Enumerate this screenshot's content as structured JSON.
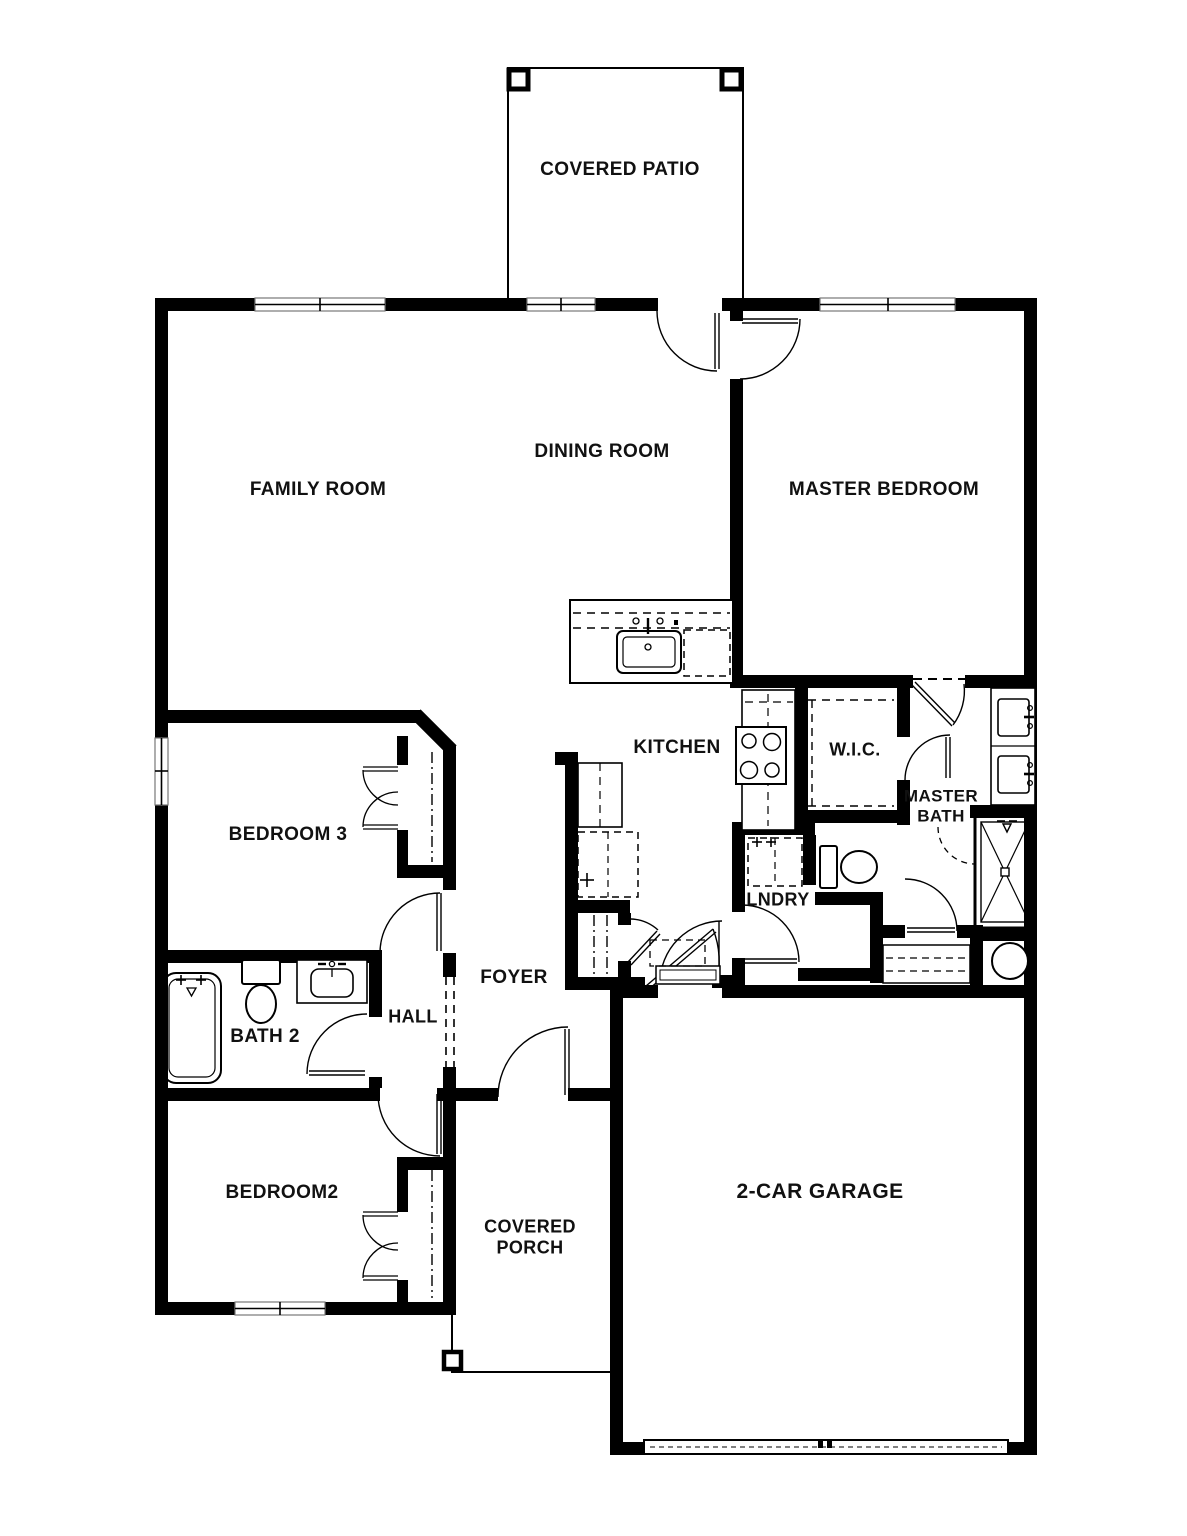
{
  "colors": {
    "wall": "#000000",
    "line": "#000000",
    "background": "#ffffff",
    "text": "#111111"
  },
  "rooms": {
    "covered_patio": "COVERED PATIO",
    "family_room": "FAMILY ROOM",
    "dining_room": "DINING ROOM",
    "master_bedroom": "MASTER BEDROOM",
    "kitchen": "KITCHEN",
    "wic": "W.I.C.",
    "master_bath": "MASTER\nBATH",
    "bedroom3": "BEDROOM 3",
    "lndry": "LNDRY",
    "foyer": "FOYER",
    "hall": "HALL",
    "bath2": "BATH 2",
    "bedroom2": "BEDROOM2",
    "covered_porch": "COVERED\nPORCH",
    "garage": "2-CAR GARAGE"
  }
}
